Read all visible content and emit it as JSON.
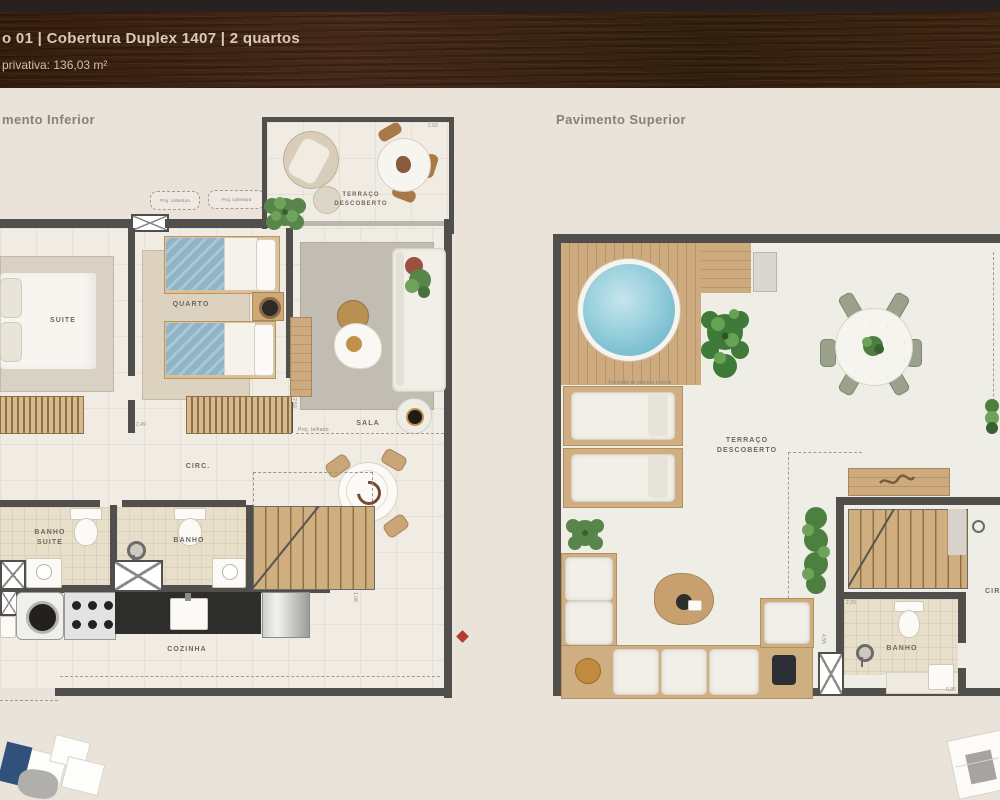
{
  "header": {
    "line1": "o 01 | Cobertura Duplex 1407 | 2 quartos",
    "line2": "privativa: 136,03 m²"
  },
  "inferior": {
    "title": "mento Inferior",
    "labels": {
      "terraco1": "TERRAÇO",
      "terraco2": "DESCOBERTO",
      "suite": "SUITE",
      "quarto": "QUARTO",
      "sala": "SALA",
      "circ": "CIRC.",
      "banho_suite1": "BANHO",
      "banho_suite2": "SUITE",
      "banho": "BANHO",
      "cozinha": "COZINHA",
      "proj_box": "Proj. cobertura",
      "proj_roof": "Proj. telhado"
    },
    "dims": {
      "d1": "2.93",
      "d2": "2.59",
      "d3": "2.49",
      "d4": "1.08"
    }
  },
  "superior": {
    "title": "Pavimento Superior",
    "labels": {
      "terraco1": "TERRAÇO",
      "terraco2": "DESCOBERTO",
      "banho": "BANHO",
      "circ": "CIRC.",
      "pool_note": "Previsão p/ piscina e deck"
    },
    "dims": {
      "d1": "2.20",
      "d2": "4.55",
      "d3": "0.36"
    }
  },
  "colors": {
    "header_wood": "#3a2113",
    "page_bg": "#e9e3da",
    "wall": "#504f4c",
    "wood": "#c9a87c",
    "pool_water": "#8fcddd",
    "unit_highlight_navy": "#31507c",
    "marker_red": "#b23a30"
  }
}
